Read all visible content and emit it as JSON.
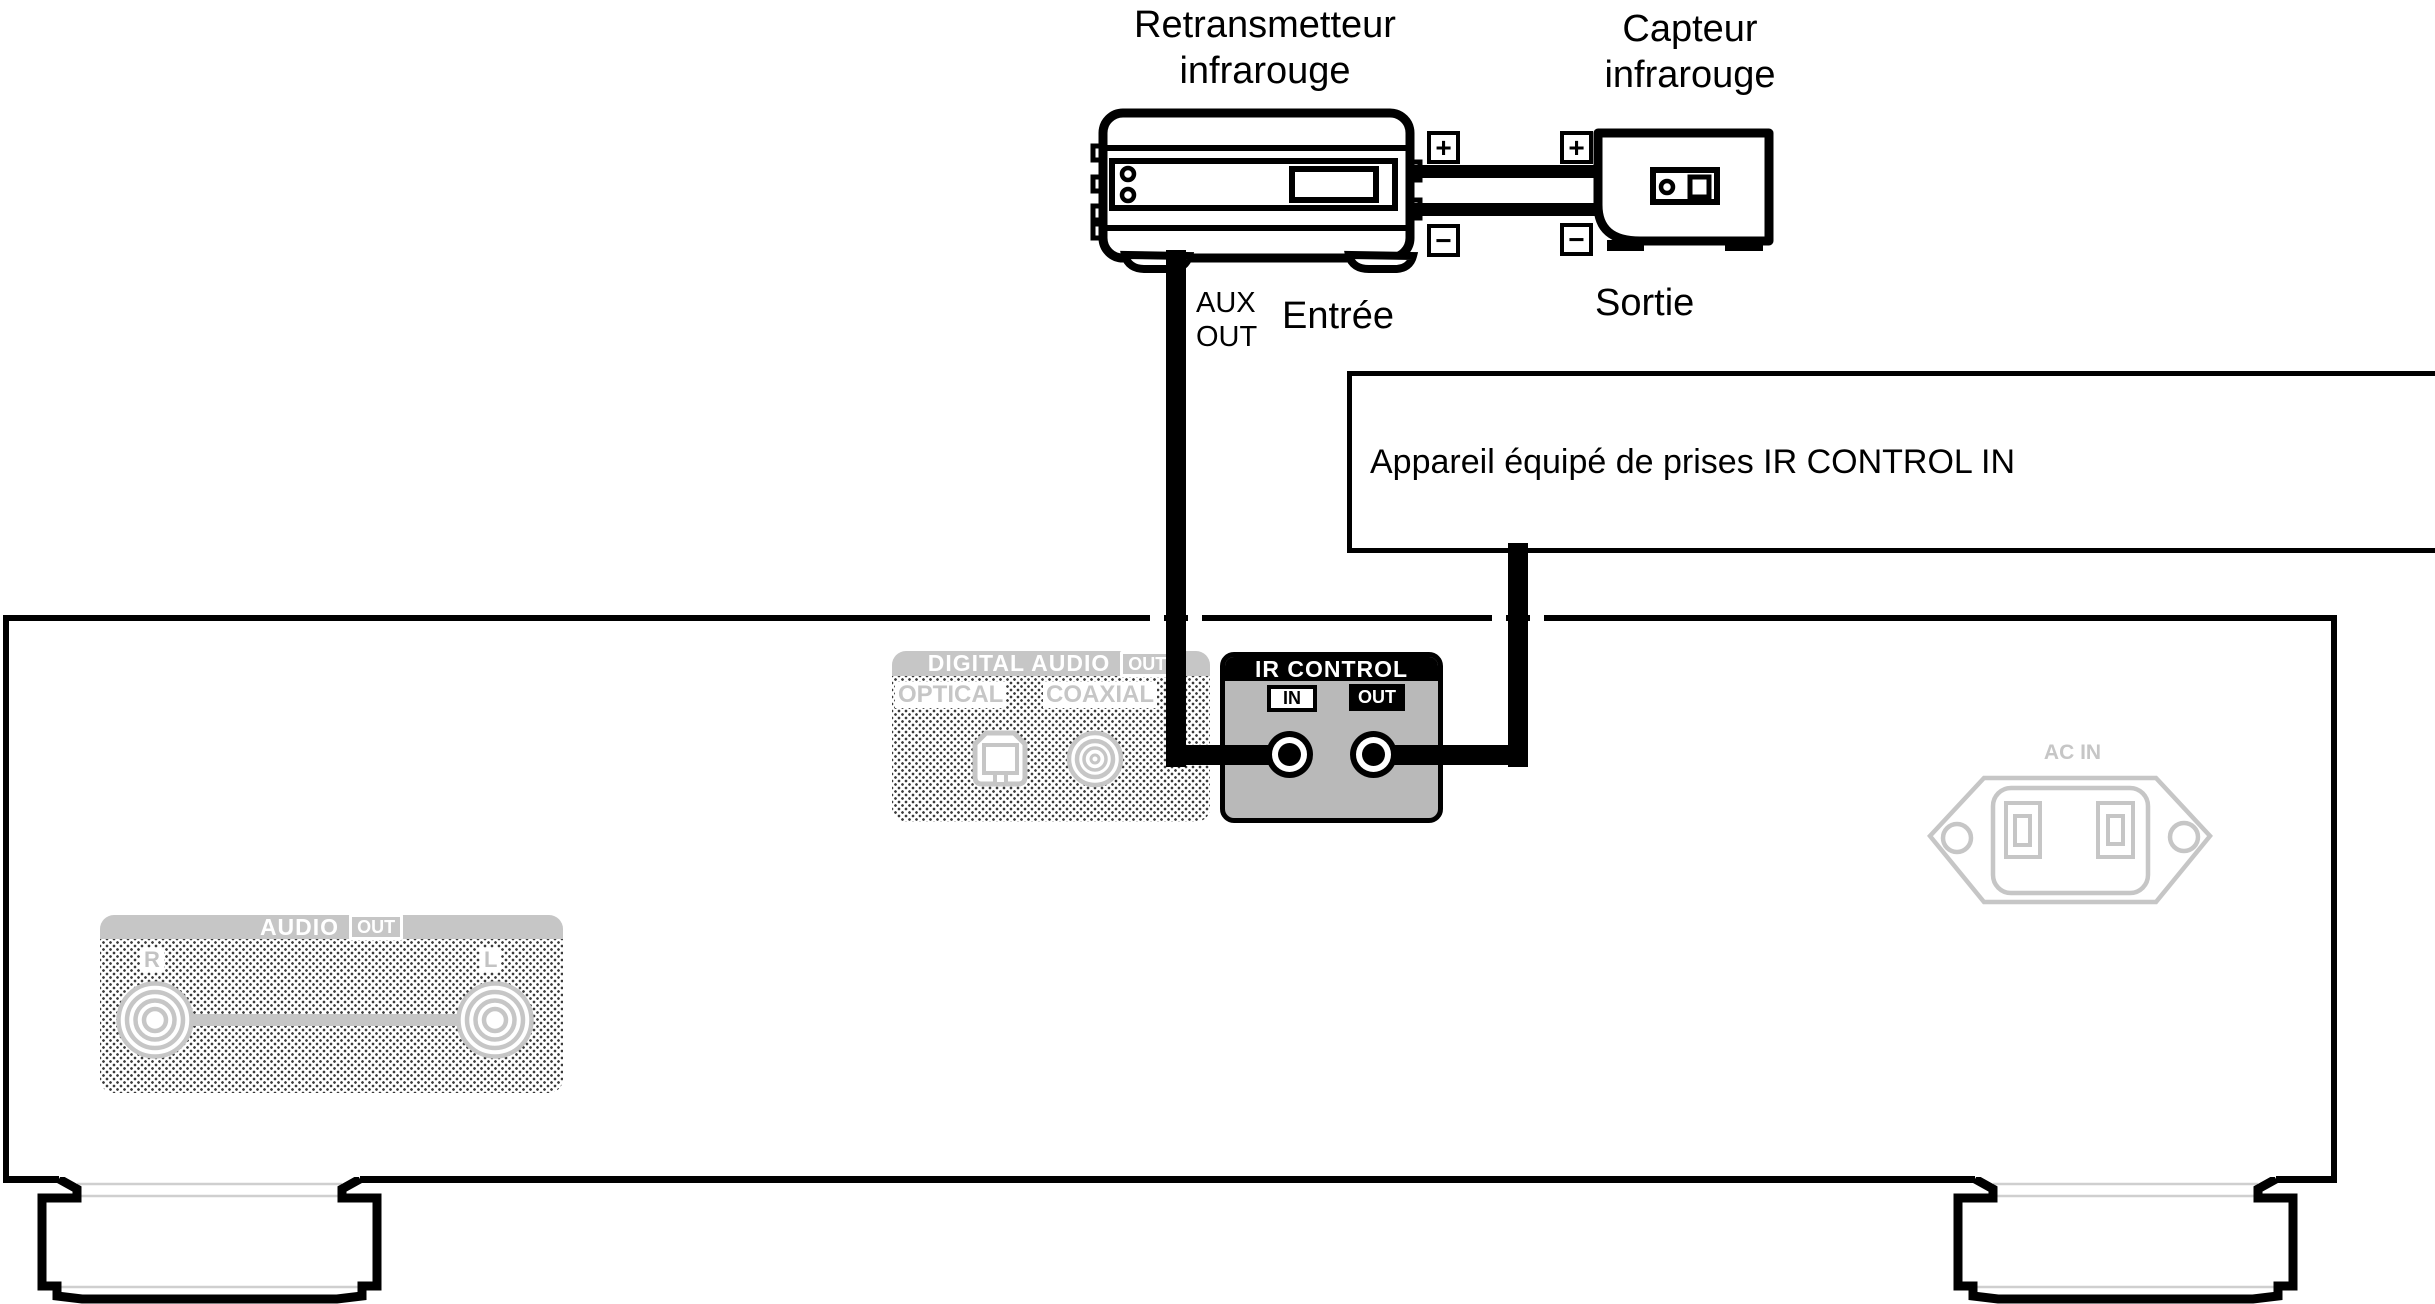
{
  "title_labels": {
    "retransmitter_line1": "Retransmetteur",
    "retransmitter_line2": "infrarouge",
    "sensor_line1": "Capteur",
    "sensor_line2": "infrarouge"
  },
  "connection_labels": {
    "aux_line1": "AUX",
    "aux_line2": "OUT",
    "input": "Entrée",
    "output": "Sortie",
    "plus": "+",
    "minus": "−"
  },
  "device_box": {
    "text": "Appareil équipé de prises IR CONTROL IN"
  },
  "rear_panel": {
    "digital_audio": {
      "title": "DIGITAL AUDIO",
      "badge": "OUT",
      "optical_label": "OPTICAL",
      "coaxial_label": "COAXIAL"
    },
    "ir_control": {
      "title": "IR CONTROL",
      "in_label": "IN",
      "out_label": "OUT"
    },
    "ac_in": {
      "label": "AC IN"
    },
    "audio_out": {
      "title": "AUDIO",
      "badge": "OUT",
      "right_label": "R",
      "left_label": "L"
    }
  },
  "colors": {
    "line": "#000000",
    "inactive_gray": "#c6c6c6",
    "ir_body_gray": "#b9b9b9"
  }
}
